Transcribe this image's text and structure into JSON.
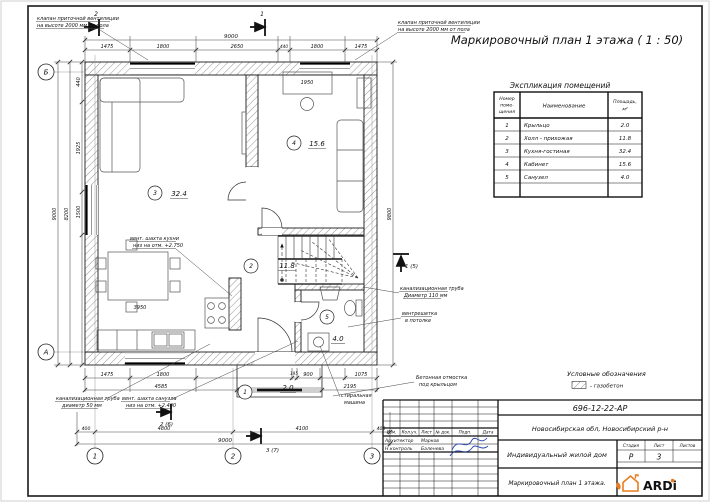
{
  "sheet_title": "Маркировочный план 1 этажа ( 1 : 50)",
  "explication": {
    "title": "Экспликация помещений",
    "columns": {
      "num": [
        "Номер",
        "поме-",
        "щения"
      ],
      "name": "Наименование",
      "area": [
        "Площадь,",
        "м²"
      ]
    },
    "rows": [
      {
        "num": "1",
        "name": "Крыльцо",
        "area": "2.0"
      },
      {
        "num": "2",
        "name": "Холл - прихожая",
        "area": "11.8"
      },
      {
        "num": "3",
        "name": "Кухня-гостиная",
        "area": "32.4"
      },
      {
        "num": "4",
        "name": "Кабинет",
        "area": "15.6"
      },
      {
        "num": "5",
        "name": "Санузел",
        "area": "4.0"
      }
    ]
  },
  "legend": {
    "title": "Условные обозначения",
    "gazobeton": "- газобетон"
  },
  "plan": {
    "grid": {
      "b": "Б",
      "a": "А",
      "n1": "1",
      "n2": "2",
      "n3": "3"
    },
    "sections": {
      "top_left": "2",
      "top_mid": "1",
      "bottom_left": "2 (6)",
      "bottom_right": "3 (7)",
      "right": "1 (5)"
    },
    "dims": {
      "top_total": "9000",
      "top": [
        "1475",
        "1800",
        "2650",
        "440",
        "1800",
        "1475"
      ],
      "left": [
        "440",
        "1925",
        "1500"
      ],
      "left_total_1": "8200",
      "left_total_2": "9000",
      "right_total": "9800",
      "bottom_1": [
        "1475",
        "1800",
        "195",
        "900",
        "1075"
      ],
      "bottom_2": [
        "4585",
        "2195"
      ],
      "bottom_3": [
        "400",
        "4800",
        "4100",
        "400"
      ],
      "bottom_total": "9000",
      "dining": "3950",
      "desk": "1950"
    },
    "annotations": {
      "vent_valve": [
        "клапан приточной вентиляции",
        "на высоте 2000 мм от пола"
      ],
      "kitchen_shaft": [
        "вент. шахта кухни",
        "низ на отм. +2.750"
      ],
      "wc_shaft": [
        "вент. шахта санузла",
        "низ на отм. +2.400"
      ],
      "sewer_50": [
        "канализационная труба",
        "диаметр 50 мм"
      ],
      "sewer_110": [
        "канализационная труба",
        "Диаметр 110 мм"
      ],
      "vent_grille": [
        "вентрешетка",
        "в потолке"
      ],
      "washer": [
        "стиральная",
        "машина"
      ],
      "apron": [
        "Бетонная отмостка",
        "под крыльцом"
      ]
    }
  },
  "stamp": {
    "doc_number": "696-12-22-АР",
    "location": "Новосибирская обл, Новосибирский р-н",
    "project": "Индивидуальный жилой дом",
    "drawing": "Маркировочный план 1 этажа.",
    "header": {
      "izm": "Изм.",
      "kol": "Кол.уч.",
      "list": "Лист",
      "doc": "№ док.",
      "podp": "Подп.",
      "date": "Дата"
    },
    "roles": [
      {
        "role": "Архитектор",
        "name": "Марков"
      },
      {
        "role": "Н.контроль",
        "name": "Баленева"
      }
    ],
    "stage_label": "Стадия",
    "list_label": "Лист",
    "listov_label": "Листов",
    "stage": "Р",
    "list_num": "3",
    "logo_text": "ARDi"
  }
}
